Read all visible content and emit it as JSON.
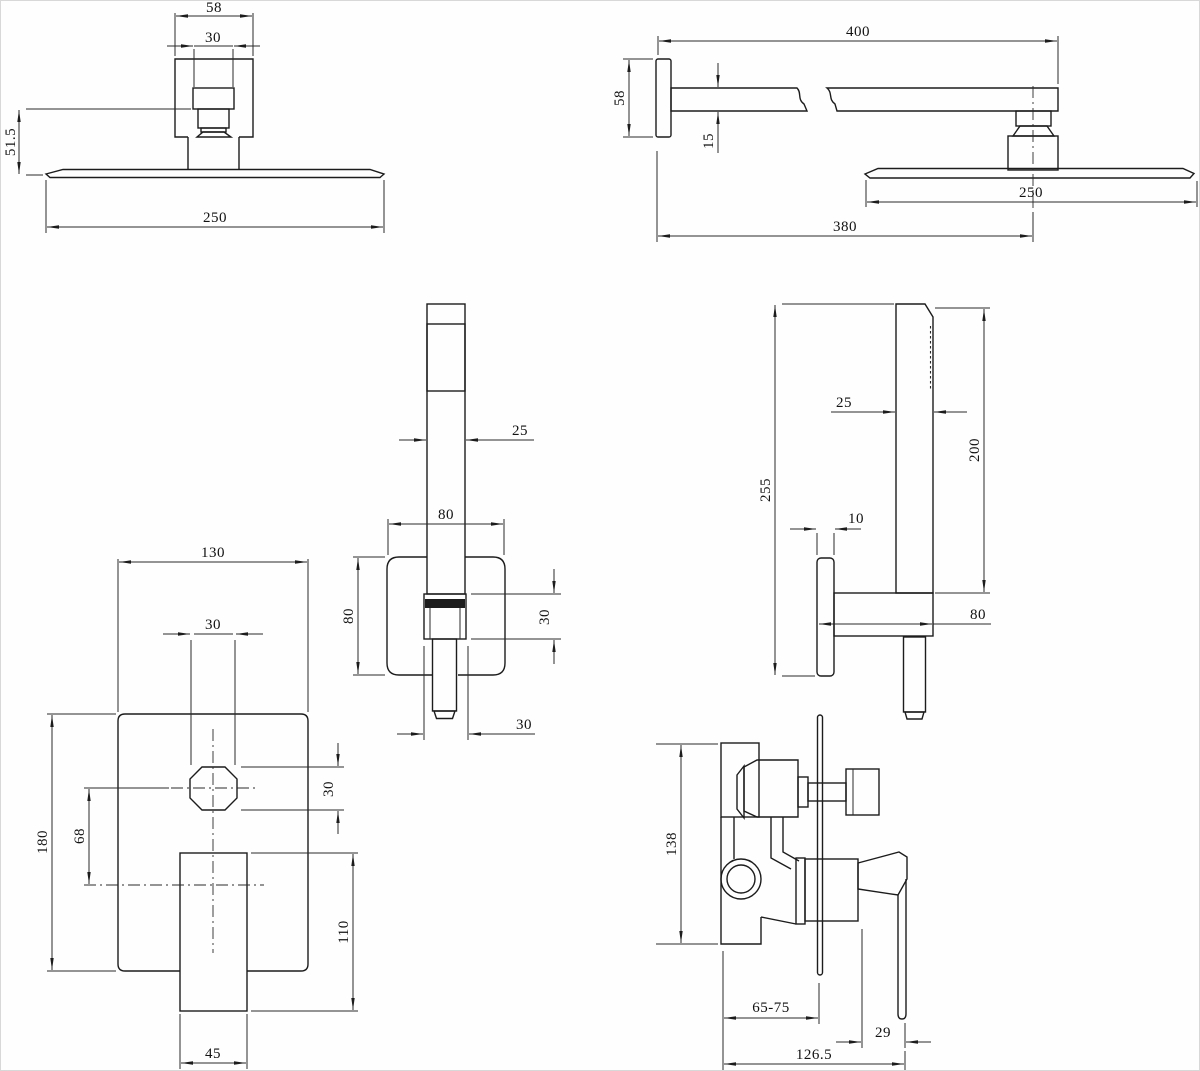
{
  "colors": {
    "background": "#ffffff",
    "line": "#1c1c1c",
    "dim_text": "#111111"
  },
  "views": {
    "shower_head_front": {
      "dims": {
        "bracket_width": "58",
        "connector_width": "30",
        "head_drop": "51.5",
        "head_diameter": "250"
      }
    },
    "shower_arm_side": {
      "dims": {
        "arm_length": "400",
        "wall_plate_height": "58",
        "arm_thickness": "15",
        "head_diameter": "250",
        "wall_to_head_center": "380"
      }
    },
    "hand_shower_front": {
      "dims": {
        "handle_width": "25",
        "holder_width": "80",
        "holder_height": "80",
        "connector_height": "30",
        "connector_width": "30"
      }
    },
    "hand_shower_side": {
      "dims": {
        "overall_height": "255",
        "handle_depth": "25",
        "handle_length": "200",
        "plate_thickness": "10",
        "holder_depth": "80"
      }
    },
    "mixer_front": {
      "dims": {
        "plate_width": "130",
        "spout_width": "30",
        "plate_height": "180",
        "spout_to_handle": "68",
        "spout_height": "30",
        "handle_length": "110",
        "handle_width": "45"
      }
    },
    "mixer_side": {
      "dims": {
        "body_height": "138",
        "install_depth": "65-75",
        "handle_offset": "29",
        "overall_depth": "126.5"
      }
    }
  }
}
